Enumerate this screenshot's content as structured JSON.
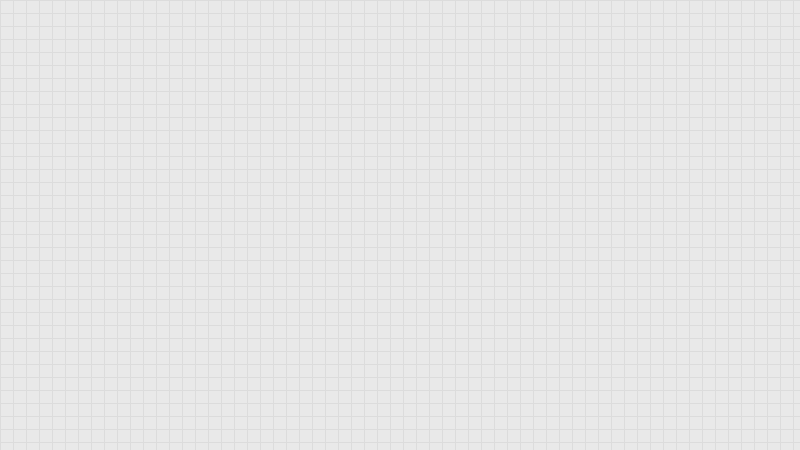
{
  "canvas": {
    "width": 800,
    "height": 450
  },
  "colors": {
    "floor": "#e9e9e9",
    "floor_grid": "#dcdcdc",
    "out_of_bounds": "#575757",
    "out_of_bounds_grid": "#6b6b6b",
    "wall": "#8a8a8a",
    "wall_cap": "#b9b9b9",
    "pipe_blue": "#1c1cc0",
    "path_yellow": "#9c9c28",
    "equipment_red": "#c02020",
    "tank_maroon": "#5c0f0f",
    "boiler_black": "#0c0c0c",
    "machine_gray": "#c9c9c9",
    "table_white": "#fafafa",
    "navy": "#1b2340",
    "red_mark": "#e02848"
  },
  "grid": {
    "pitch": 13
  },
  "bands": [
    [
      0,
      0,
      800,
      61
    ],
    [
      0,
      396,
      800,
      54
    ]
  ],
  "walls": [
    [
      0,
      58,
      452,
      5
    ],
    [
      128,
      142,
      324,
      5
    ],
    [
      172,
      227,
      280,
      5
    ],
    [
      0,
      307,
      452,
      5
    ],
    [
      172,
      334,
      280,
      5
    ],
    [
      128,
      58,
      5,
      338
    ],
    [
      169,
      58,
      5,
      338
    ],
    [
      328,
      58,
      5,
      89
    ],
    [
      447,
      58,
      5,
      338
    ],
    [
      308,
      142,
      5,
      90
    ],
    [
      345,
      227,
      5,
      85
    ],
    [
      218,
      227,
      5,
      85
    ],
    [
      196,
      334,
      4,
      62
    ],
    [
      246,
      334,
      4,
      62
    ],
    [
      306,
      334,
      4,
      62
    ],
    [
      328,
      334,
      4,
      62
    ],
    [
      366,
      334,
      4,
      62
    ],
    [
      413,
      334,
      4,
      62
    ]
  ],
  "doors": [
    [
      143,
      57,
      21,
      7
    ],
    [
      339,
      57,
      26,
      7
    ],
    [
      176,
      142,
      15,
      6
    ],
    [
      297,
      142,
      16,
      6
    ],
    [
      187,
      227,
      20,
      5
    ],
    [
      413,
      227,
      18,
      5
    ],
    [
      317,
      307,
      25,
      5
    ],
    [
      355,
      307,
      21,
      5
    ],
    [
      218,
      334,
      14,
      5
    ],
    [
      258,
      334,
      12,
      5
    ],
    [
      351,
      334,
      15,
      5
    ],
    [
      419,
      334,
      19,
      5
    ],
    [
      128,
      124,
      5,
      18
    ],
    [
      128,
      224,
      5,
      16
    ],
    [
      128,
      279,
      5,
      14
    ],
    [
      169,
      94,
      5,
      17
    ],
    [
      169,
      187,
      5,
      16
    ],
    [
      169,
      245,
      5,
      14
    ],
    [
      169,
      299,
      5,
      12
    ],
    [
      169,
      357,
      5,
      15
    ],
    [
      328,
      60,
      5,
      13
    ],
    [
      447,
      299,
      5,
      18
    ],
    [
      308,
      185,
      5,
      17
    ],
    [
      345,
      254,
      5,
      17
    ],
    [
      218,
      257,
      5,
      15
    ]
  ],
  "caps": [
    [
      130,
      60
    ],
    [
      172,
      60
    ],
    [
      330,
      60
    ],
    [
      448,
      60
    ],
    [
      130,
      145
    ],
    [
      172,
      145
    ],
    [
      330,
      145
    ],
    [
      448,
      145
    ],
    [
      172,
      230
    ],
    [
      220,
      230
    ],
    [
      310,
      230
    ],
    [
      347,
      230
    ],
    [
      448,
      230
    ],
    [
      130,
      310
    ],
    [
      172,
      310
    ],
    [
      220,
      310
    ],
    [
      347,
      310
    ],
    [
      448,
      310
    ],
    [
      172,
      337
    ],
    [
      448,
      337
    ],
    [
      130,
      396
    ],
    [
      172,
      396
    ],
    [
      198,
      396
    ],
    [
      248,
      396
    ],
    [
      308,
      396
    ],
    [
      330,
      396
    ],
    [
      368,
      396
    ],
    [
      415,
      396
    ],
    [
      448,
      396
    ],
    [
      540,
      397
    ]
  ],
  "pipes": [
    [
      62,
      75,
      58,
      2
    ],
    [
      108,
      97,
      104,
      2
    ],
    [
      62,
      130,
      60,
      2
    ],
    [
      108,
      145,
      56,
      2
    ],
    [
      62,
      159,
      98,
      2
    ],
    [
      118,
      182,
      98,
      2
    ],
    [
      63,
      188,
      42,
      2
    ],
    [
      63,
      209,
      62,
      2
    ],
    [
      155,
      202,
      78,
      2
    ],
    [
      0,
      238,
      152,
      2
    ],
    [
      0,
      242,
      156,
      2
    ],
    [
      36,
      246,
      28,
      2
    ],
    [
      95,
      265,
      60,
      2
    ],
    [
      95,
      269,
      64,
      2
    ],
    [
      62,
      286,
      82,
      2
    ],
    [
      64,
      75,
      2,
      57
    ],
    [
      84,
      97,
      2,
      64
    ],
    [
      104,
      75,
      2,
      72
    ],
    [
      114,
      97,
      2,
      170
    ],
    [
      120,
      85,
      2,
      202
    ],
    [
      124,
      130,
      2,
      158
    ],
    [
      140,
      159,
      2,
      45
    ],
    [
      210,
      97,
      2,
      87
    ],
    [
      216,
      124,
      2,
      60
    ],
    [
      149,
      142,
      2,
      182
    ],
    [
      153,
      148,
      2,
      172
    ],
    [
      157,
      154,
      2,
      162
    ],
    [
      149,
      322,
      112,
      2
    ],
    [
      153,
      318,
      104,
      2
    ],
    [
      157,
      314,
      96,
      2
    ],
    [
      196,
      324,
      2,
      28
    ],
    [
      202,
      318,
      2,
      34
    ],
    [
      180,
      335,
      2,
      16
    ],
    [
      259,
      322,
      2,
      20
    ],
    [
      150,
      324,
      2,
      70
    ],
    [
      48,
      339,
      62,
      2
    ],
    [
      79,
      341,
      2,
      38
    ],
    [
      50,
      360,
      112,
      2
    ],
    [
      40,
      377,
      54,
      2
    ],
    [
      180,
      84,
      130,
      2
    ],
    [
      255,
      102,
      38,
      2
    ],
    [
      198,
      124,
      122,
      2
    ],
    [
      198,
      139,
      78,
      2
    ],
    [
      191,
      112,
      2,
      14
    ],
    [
      216,
      112,
      2,
      14
    ],
    [
      244,
      112,
      2,
      29
    ],
    [
      269,
      112,
      2,
      14
    ],
    [
      292,
      84,
      2,
      20
    ],
    [
      308,
      84,
      2,
      42
    ],
    [
      352,
      84,
      2,
      42
    ],
    [
      371,
      84,
      2,
      42
    ],
    [
      352,
      103,
      21,
      2
    ],
    [
      340,
      139,
      58,
      2
    ],
    [
      397,
      112,
      2,
      29
    ],
    [
      427,
      112,
      2,
      10
    ],
    [
      432,
      87,
      18,
      2
    ],
    [
      257,
      150,
      36,
      2
    ],
    [
      256,
      206,
      48,
      2
    ],
    [
      267,
      186,
      2,
      30
    ],
    [
      281,
      186,
      2,
      30
    ]
  ],
  "gray_links": [
    [
      208,
      165,
      34,
      2
    ],
    [
      210,
      205,
      30,
      2
    ]
  ],
  "marks": {
    "blue": [
      [
        247,
        232,
        30,
        2
      ],
      [
        257,
        263,
        34,
        2
      ]
    ],
    "red": [
      [
        294,
        296,
        12,
        2
      ],
      [
        363,
        252,
        46,
        2
      ]
    ]
  },
  "yellow_lines": [
    {
      "points": [
        [
          333,
          107
        ],
        [
          370,
          170
        ],
        [
          427,
          268
        ],
        [
          458,
          332
        ],
        [
          470,
          368
        ],
        [
          478,
          404
        ],
        [
          481,
          430
        ],
        [
          482,
          450
        ]
      ]
    },
    {
      "points": [
        [
          396,
          100
        ],
        [
          436,
          185
        ],
        [
          473,
          262
        ],
        [
          519,
          365
        ],
        [
          532,
          394
        ],
        [
          541,
          422
        ],
        [
          545,
          450
        ]
      ]
    }
  ],
  "equipment": {
    "pumps": [
      [
        7,
        71
      ],
      [
        7,
        126
      ],
      [
        7,
        183
      ],
      [
        1,
        240
      ],
      [
        7,
        295
      ]
    ],
    "tanks": [
      [
        72,
        87
      ],
      [
        72,
        107
      ],
      [
        72,
        128
      ],
      [
        72,
        148
      ],
      [
        72,
        219
      ],
      [
        72,
        243
      ]
    ],
    "boilers": [
      [
        15,
        96,
        47,
        26
      ],
      [
        15,
        152,
        47,
        26
      ],
      [
        16,
        205,
        47,
        24
      ],
      [
        16,
        257,
        47,
        24
      ]
    ],
    "exchangers": [
      [
        187,
        68
      ],
      [
        212,
        68
      ],
      [
        240,
        68
      ],
      [
        265,
        68
      ],
      [
        396,
        70
      ],
      [
        423,
        70
      ]
    ],
    "machines": [
      [
        185,
        157,
        24,
        18
      ],
      [
        185,
        198,
        26,
        17
      ],
      [
        410,
        158,
        22,
        17
      ],
      [
        410,
        204,
        23,
        17
      ],
      [
        381,
        360,
        12,
        25
      ]
    ],
    "tables": [
      [
        242,
        156,
        52,
        22
      ],
      [
        240,
        197,
        54,
        20
      ]
    ],
    "cell_rows": [
      [
        322,
        157,
        57,
        21
      ],
      [
        322,
        200,
        57,
        22
      ]
    ],
    "light_rows": [
      [
        380,
        160,
        28,
        16
      ],
      [
        380,
        202,
        30,
        18
      ]
    ],
    "desks": [
      [
        248,
        242,
        68,
        14
      ],
      [
        318,
        243,
        16,
        13
      ],
      [
        252,
        281,
        84,
        20
      ],
      [
        362,
        242,
        53,
        14
      ],
      [
        362,
        284,
        68,
        17
      ]
    ],
    "shelves": [
      [
        334,
        348,
        8,
        30
      ],
      [
        348,
        348,
        9,
        30
      ],
      [
        431,
        349,
        9,
        30
      ]
    ],
    "stairs": [
      212,
      345,
      33,
      41
    ],
    "navy_box": [
      93,
      375,
      24,
      14
    ],
    "shower": [
      250,
      340,
      13,
      22
    ],
    "tub": [
      279,
      362,
      25,
      14
    ],
    "sinks": [
      [
        270,
        349
      ],
      [
        279,
        351
      ]
    ],
    "black_circle": [
      297,
      351,
      6
    ],
    "stools": [
      [
        254,
        383
      ],
      [
        263,
        386
      ],
      [
        280,
        383
      ],
      [
        288,
        386
      ],
      [
        296,
        385
      ]
    ],
    "dots": [
      [
        250,
        380
      ],
      [
        259,
        389
      ],
      [
        277,
        380
      ],
      [
        285,
        389
      ],
      [
        300,
        388
      ]
    ]
  }
}
